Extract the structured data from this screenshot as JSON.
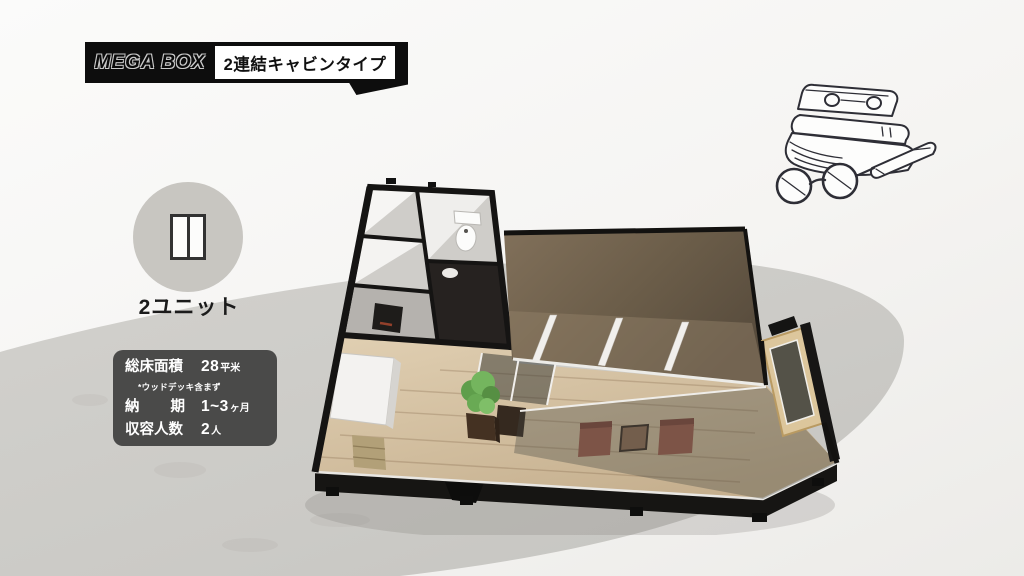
{
  "header": {
    "brand": "MEGA BOX",
    "type_label": "2連結キャビンタイプ"
  },
  "badge": {
    "label": "2ユニット",
    "icon": "two-connected-units-icon"
  },
  "specs": {
    "floor_area_label": "総床面積",
    "floor_area_value": "28",
    "floor_area_unit": "平米",
    "floor_area_note": "*ウッドデッキ含まず",
    "delivery_label_left": "納",
    "delivery_label_right": "期",
    "delivery_value": "1~3",
    "delivery_unit": "ヶ月",
    "capacity_label": "収容人数",
    "capacity_value": "2",
    "capacity_unit": "人"
  },
  "floorplan": {
    "description": "isometric 3D floor plan of 2-connected cabin unit"
  },
  "icons": {
    "badge_icon": "two-connected-units-icon",
    "illustration": "books-glasses-pen-sketch-icon"
  },
  "colors": {
    "accent_black": "#0d0d0d",
    "spec_panel_gray": "#4a4a49",
    "badge_circle_gray": "#c8c6c1",
    "backdrop_ellipse_gray": "#cdccc8",
    "roof_brown": "#6e5f4b",
    "floor_wood": "#d3bfa1",
    "chair_terracotta": "#9c5b4b"
  }
}
